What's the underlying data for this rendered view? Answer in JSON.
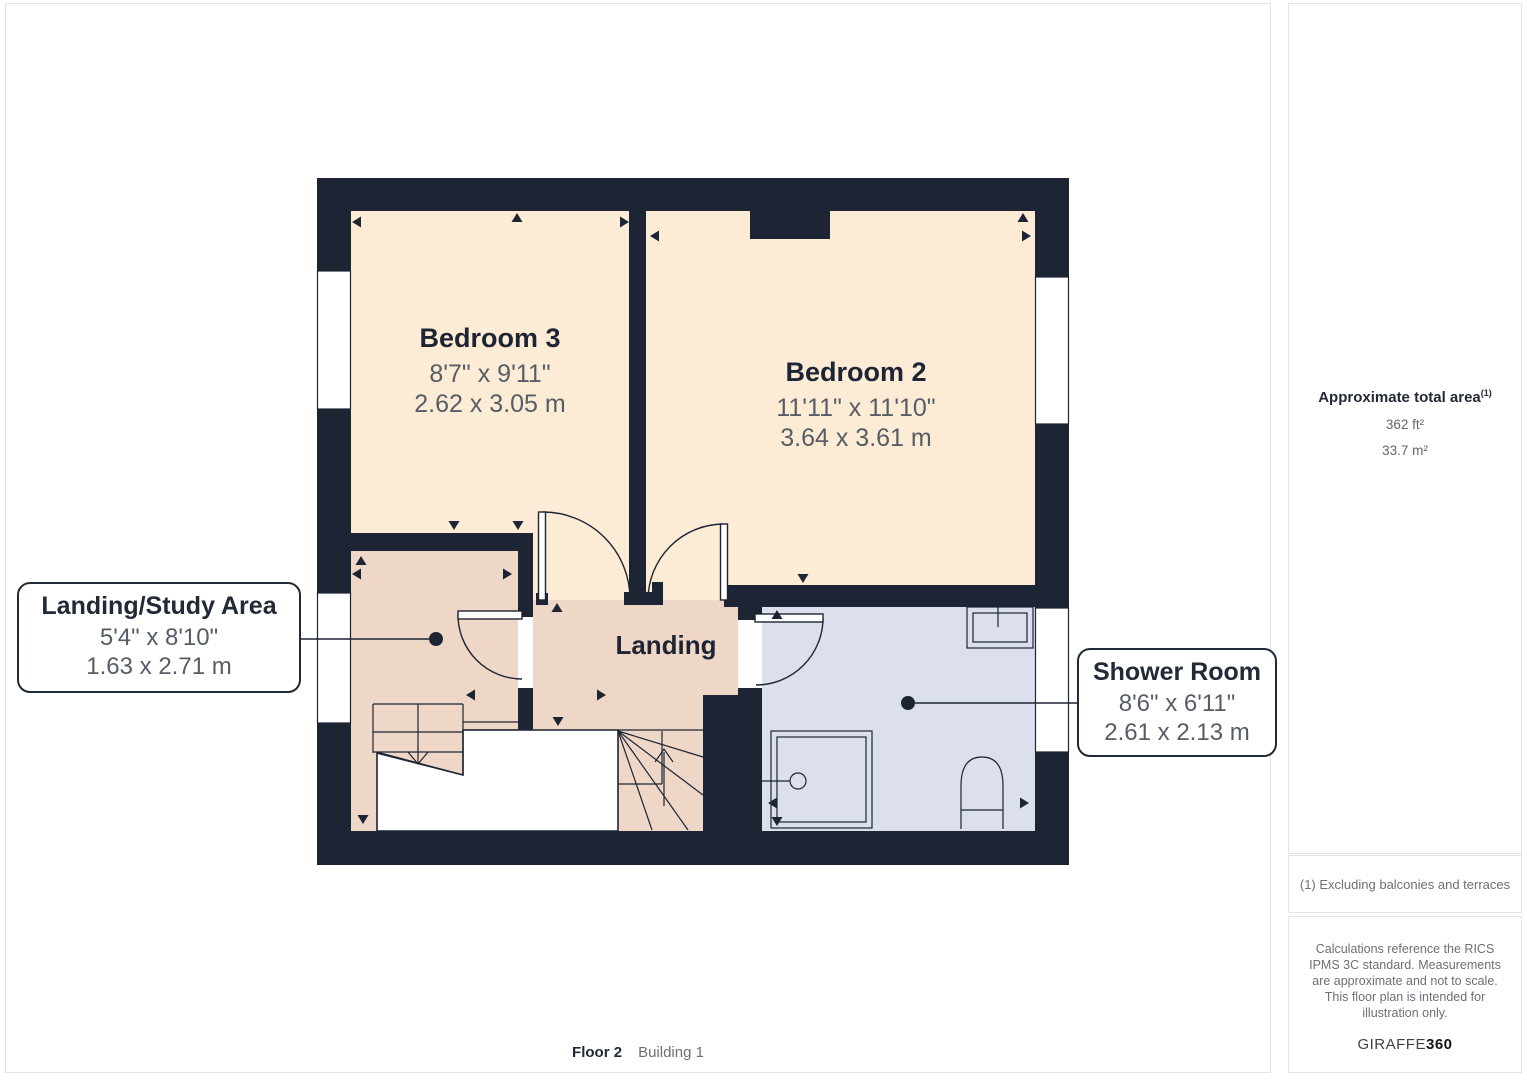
{
  "floorplan": {
    "rooms": [
      {
        "name": "Bedroom 3",
        "imperial": "8'7\" x 9'11\"",
        "metric": "2.62 x 3.05 m"
      },
      {
        "name": "Bedroom 2",
        "imperial": "11'11\" x 11'10\"",
        "metric": "3.64 x 3.61 m"
      },
      {
        "name": "Landing"
      }
    ],
    "callouts": [
      {
        "title": "Landing/Study Area",
        "imperial": "5'4\" x 8'10\"",
        "metric": "1.63 x 2.71 m"
      },
      {
        "title": "Shower Room",
        "imperial": "8'6\" x 6'11\"",
        "metric": "2.61 x 2.13 m"
      }
    ],
    "icons": [
      "bed-room-area",
      "shower-tray",
      "toilet",
      "sink",
      "staircase",
      "windows",
      "door-swings"
    ]
  },
  "sidebar": {
    "area_title": "Approximate total area",
    "area_ref": "(1)",
    "area_ft": "362 ft²",
    "area_m": "33.7 m²",
    "note": "(1) Excluding balconies and terraces",
    "disclaimer": "Calculations reference the RICS IPMS 3C standard. Measurements are approximate and not to scale. This floor plan is intended for illustration only.",
    "logo_text": "GIRAFFE",
    "logo_bold": "360"
  },
  "footer": {
    "floor_label": "Floor 2",
    "building_label": "Building 1"
  },
  "colors": {
    "wall": "#1d2433",
    "bedroom_fill": "#fcecd5",
    "landing_fill": "#eed7c6",
    "shower_fill": "#dbe0ec",
    "dimension_text": "#565d66",
    "panel_border": "#e4e4e6"
  }
}
